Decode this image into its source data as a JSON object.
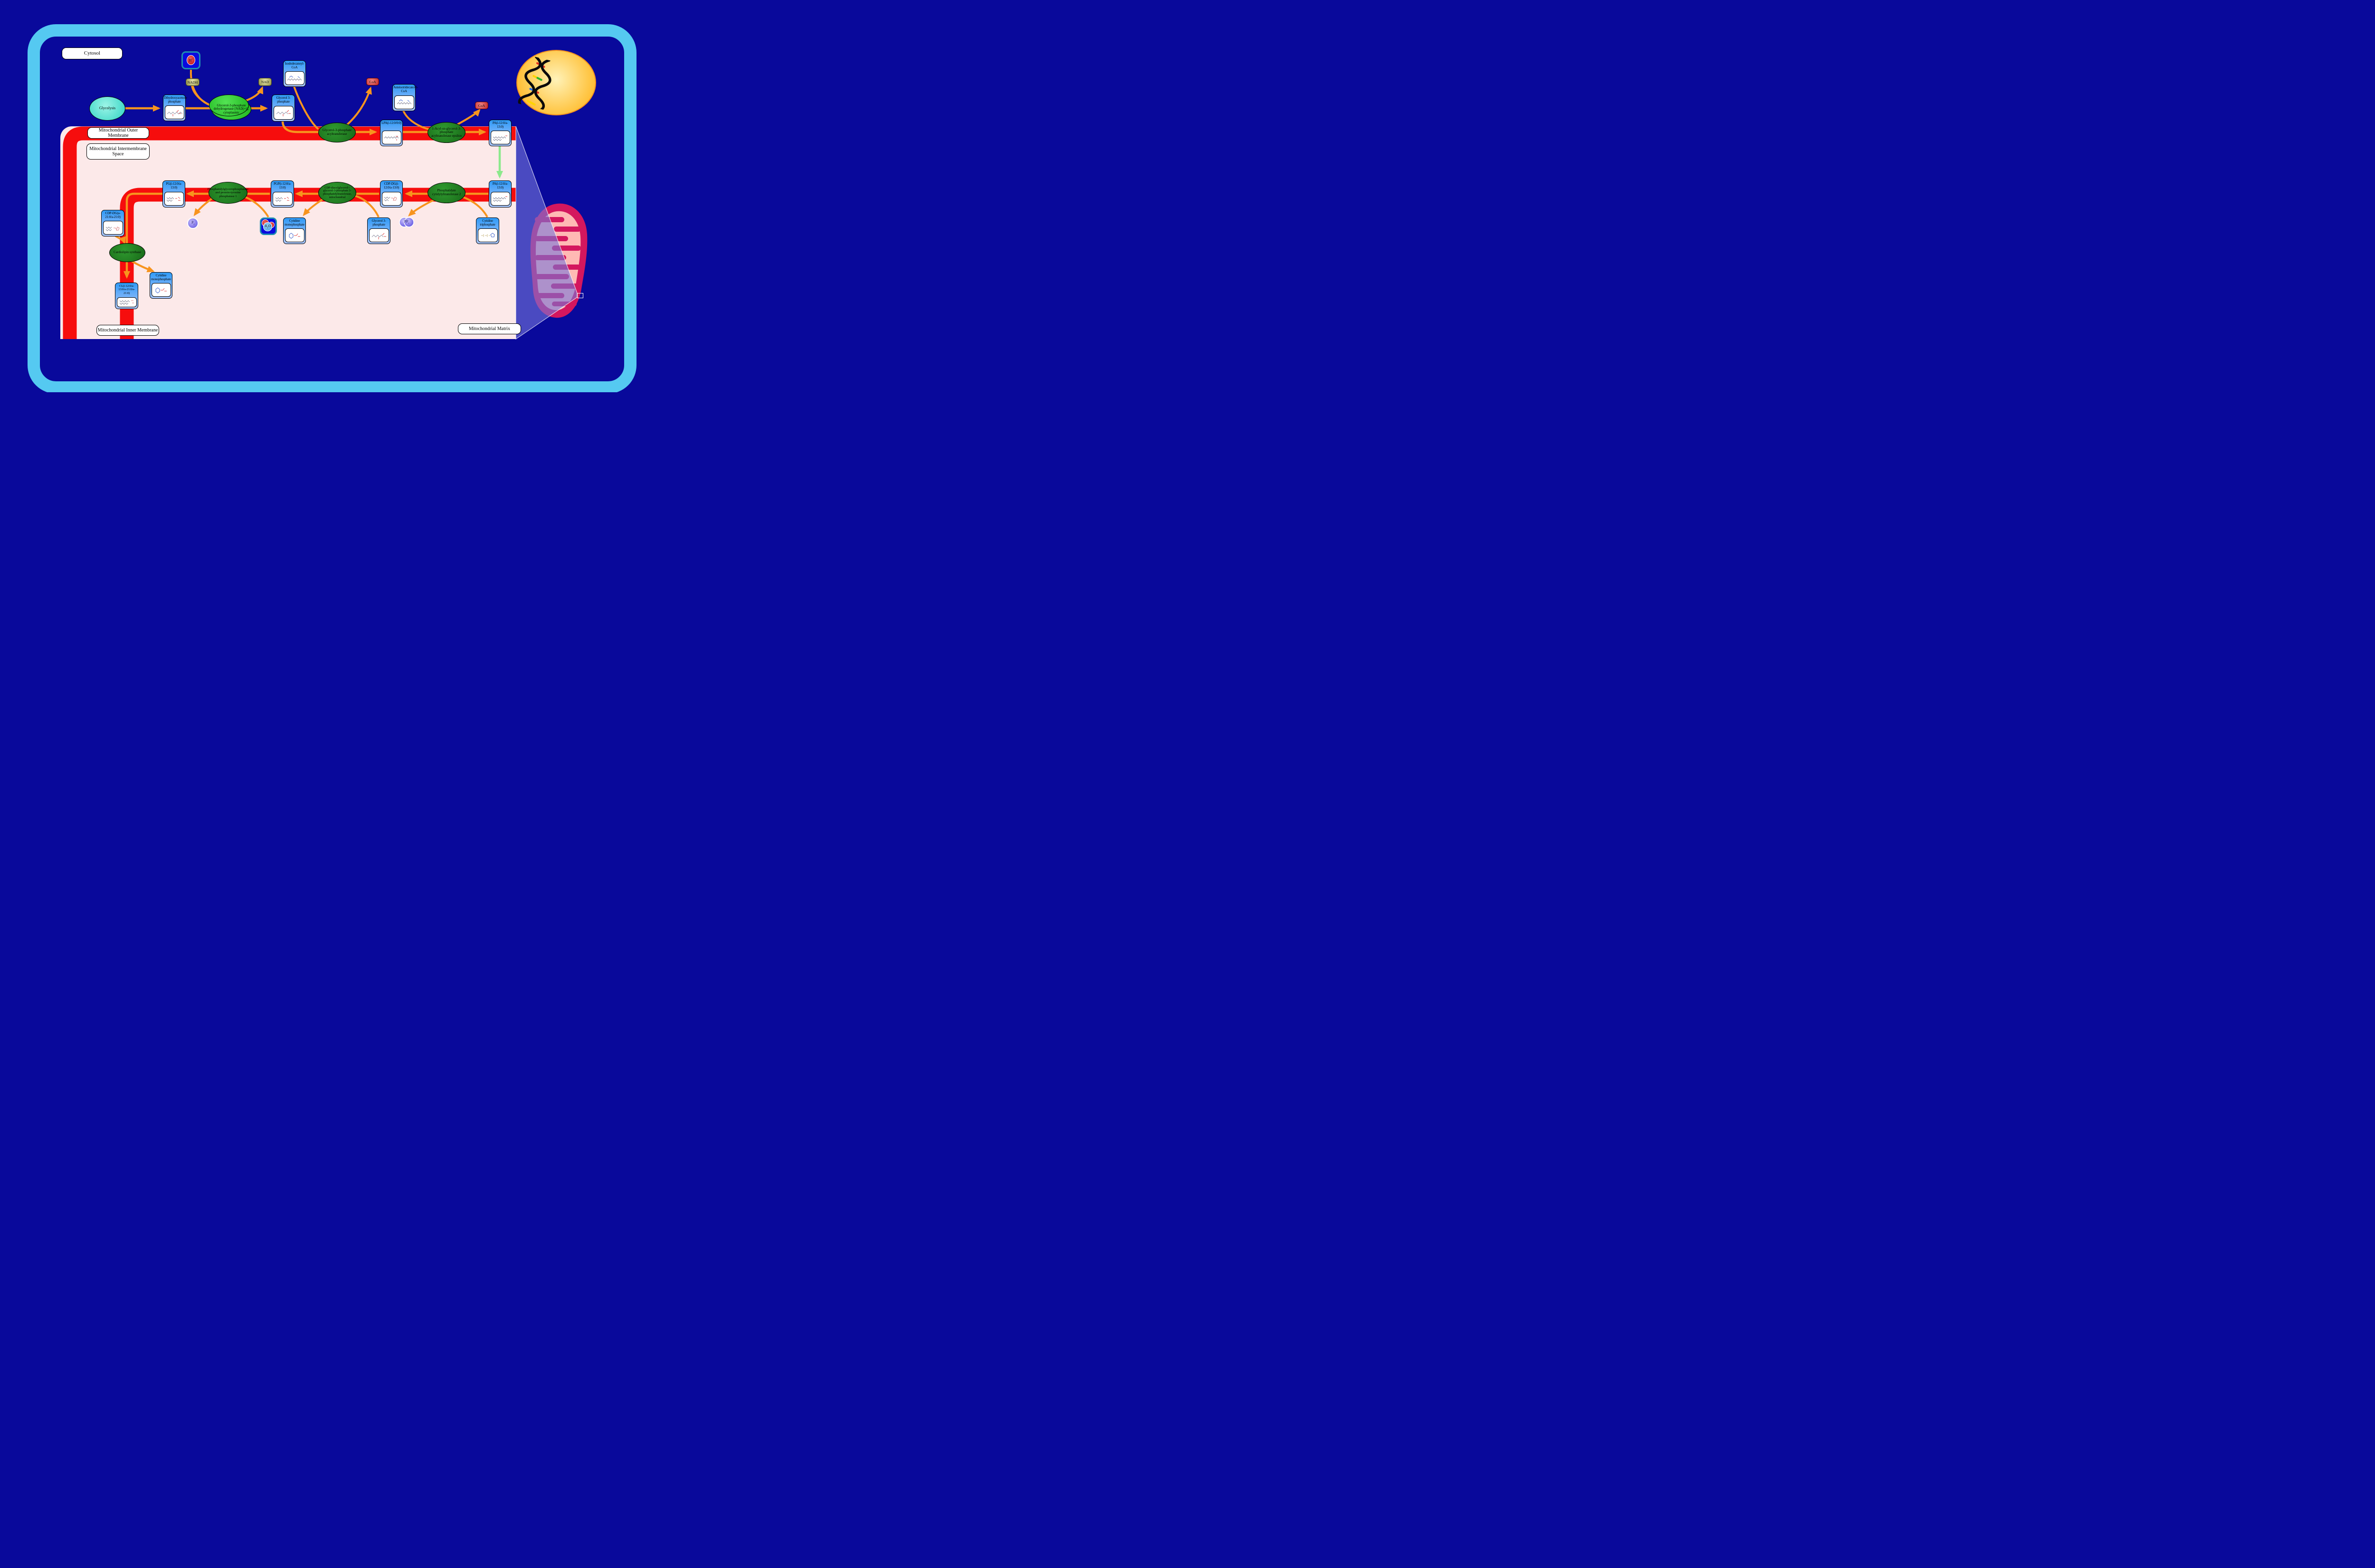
{
  "regions": {
    "cytosol": "Cytosol",
    "outer_membrane": "Mitochondrial Outer Membrane",
    "intermembrane_space": "Mitochondrial Intermembrane Space",
    "inner_membrane": "Mitochondrial Inner Membrane",
    "matrix": "Mitochondrial Matrix"
  },
  "pathways": {
    "glycolysis": "Glycolysis"
  },
  "metabolites": {
    "dhap": "Dihydroxyacetone phosphate",
    "g3p_cytosol": "Glycerol 3-phosphate",
    "isododecanoyl_coa": "Isododecanoyl-CoA",
    "lpa": "LPA(i-12:0/0:0)",
    "anteisotridecanoyl_coa": "Anteisotridecanoyl-CoA",
    "pa_outer": "PA(i-12:0/a-13:0)",
    "pa_inner": "PA(i-12:0/a-13:0)",
    "cdp_dg_inner": "CDP-DG(i-12:0/a-13:0)",
    "pgp": "PGP(i-12:0/a-13:0)",
    "pg": "PG(i-12:0/a-13:0)",
    "cdp_dg_a21": "CDP-DG(a-21:0/a-21:0)",
    "cl": "CL(i-12:0/a-13:0/a-21:0/a-21:0)",
    "cmp_inner": "Cytidine monophosphate",
    "cmp_matrix": "Cytidine monophosphate",
    "ctp": "Cytidine triphosphate",
    "g3p_matrix": "Glycerol 3-phosphate"
  },
  "enzymes": {
    "gpd": "Glycerol-3-phosphate dehydrogenase [NAD(+)], cytoplasmic",
    "gpat": "Glycerol-3-phosphate acyltransferase",
    "agpat_epsilon": "1-Acyl-sn-glycerol-3-phosphate acyltransferase epsilon",
    "pct2": "Phosphatidate cytidylyltransferase 2",
    "cdpdag_g3p_transferase": "CDP-diacylglycerol--glycerol-3-phosphate 3-phosphatidyltransferase, mitochondrial",
    "pgp_phosphatase": "Phosphatidylglycerophosphatase and protein-tyrosine phosphatase 1",
    "cardiolipin_synthase": "Cardiolipin synthase"
  },
  "small_molecules": {
    "nadh": "NADH",
    "nad": "NAD",
    "coa_1": "CoA",
    "coa_2": "CoA",
    "h_plus": {
      "base": "H",
      "sup": "+"
    },
    "h2o": {
      "base": "H",
      "sub": "2",
      "tail": "O"
    },
    "pi": {
      "base": "P",
      "sub": "i"
    },
    "ppi": {
      "base": "PP",
      "sub": "i"
    }
  },
  "colors": {
    "background": "#09099B",
    "cell_border": "#55C9F1",
    "panel_pink": "#FCE9E9",
    "membrane_red": "#F60D0D",
    "arrow_orange": "#F7941E",
    "arrow_green": "#8CE98C",
    "metabolite_header_blue": "#2E9AF7",
    "enzyme_green": "#1E7D1E",
    "enzyme_bright_green": "#2BCB2B",
    "pathway_teal": "#40E0D0",
    "nucleus_yellow": "#FFC94D",
    "mitochondrion_outer": "#D4175E",
    "mitochondrion_inner": "#FFB9B4"
  }
}
